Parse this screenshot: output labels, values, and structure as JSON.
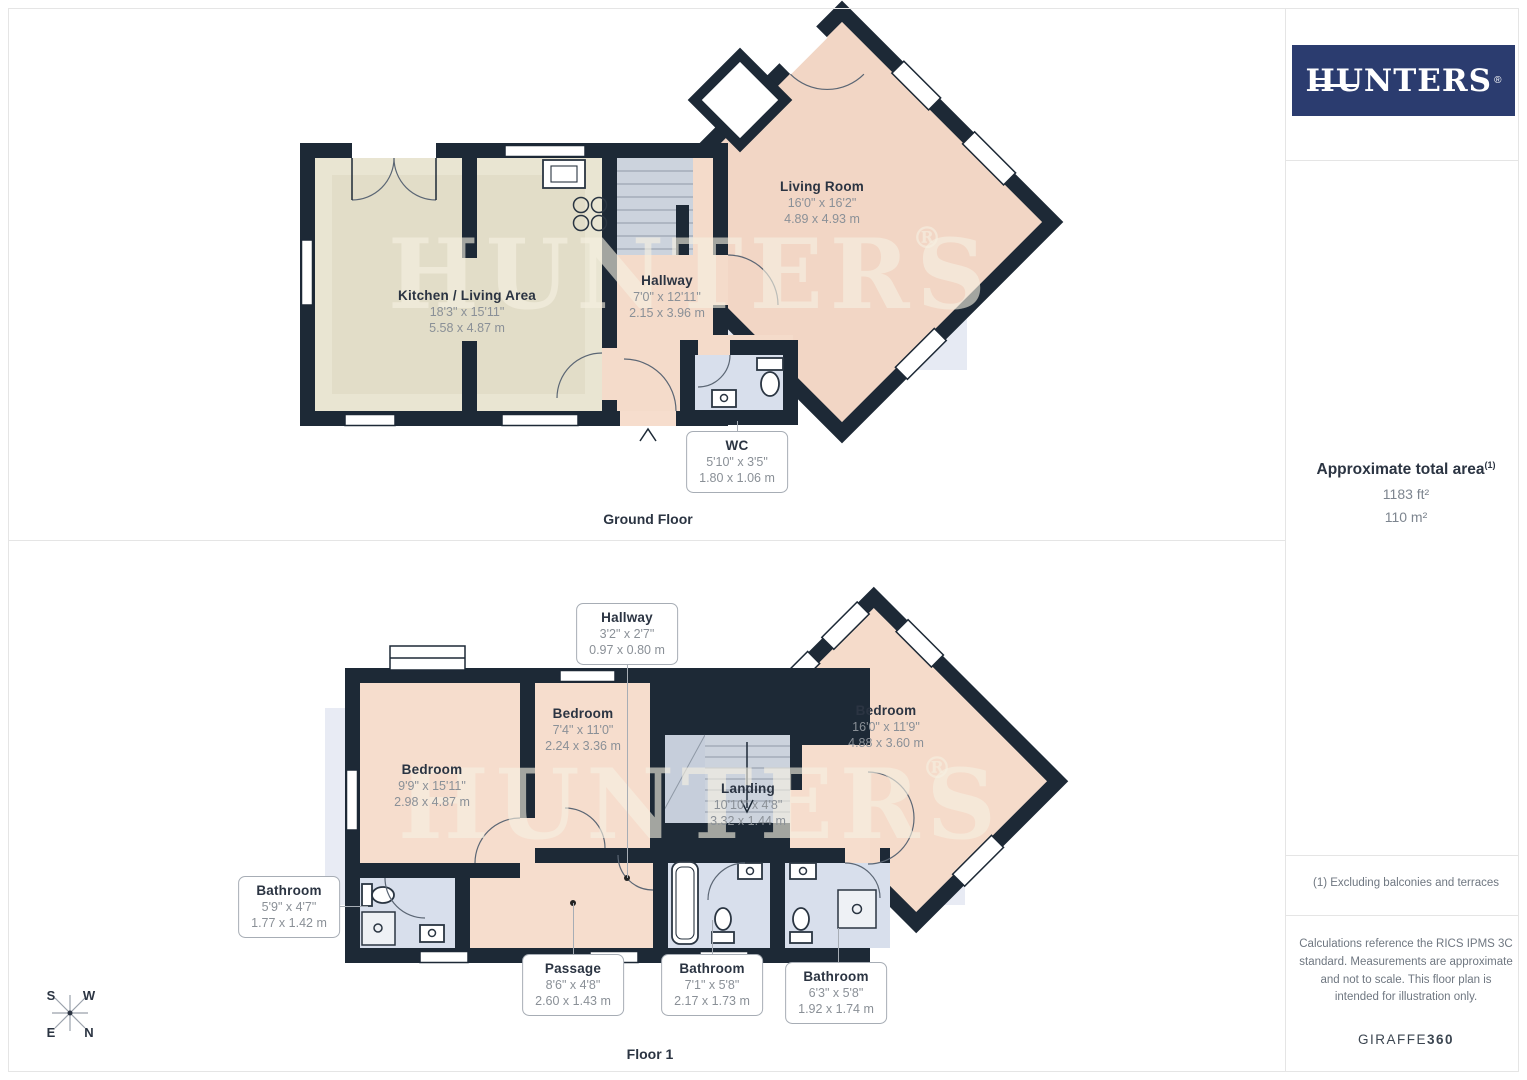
{
  "brand": {
    "logo_text": "HUNTERS",
    "registered": "®",
    "watermark": "HUNTERS",
    "watermark_reg": "®",
    "logo_bg_color": "#2b3c6f"
  },
  "sidebar": {
    "approx_label": "Approximate total area",
    "approx_sup": "(1)",
    "area_ft": "1183 ft²",
    "area_m": "110 m²",
    "footnote": "(1) Excluding balconies and terraces",
    "disclaimer": "Calculations reference the RICS IPMS 3C standard. Measurements are approximate and not to scale. This floor plan is intended for illustration only.",
    "credit_main": "GIRAFFE",
    "credit_bold": "360"
  },
  "ground_floor": {
    "title": "Ground Floor",
    "kitchen_living": {
      "name": "Kitchen / Living Area",
      "imperial": "18'3\" x 15'11\"",
      "metric": "5.58 x 4.87 m"
    },
    "hallway": {
      "name": "Hallway",
      "imperial": "7'0\" x 12'11\"",
      "metric": "2.15 x 3.96 m"
    },
    "living_room": {
      "name": "Living Room",
      "imperial": "16'0\" x 16'2\"",
      "metric": "4.89 x 4.93 m"
    },
    "wc": {
      "name": "WC",
      "imperial": "5'10\" x 3'5\"",
      "metric": "1.80 x 1.06 m"
    }
  },
  "floor1": {
    "title": "Floor 1",
    "hallway": {
      "name": "Hallway",
      "imperial": "3'2\" x 2'7\"",
      "metric": "0.97 x 0.80 m"
    },
    "bedroom_left": {
      "name": "Bedroom",
      "imperial": "9'9\" x 15'11\"",
      "metric": "2.98 x 4.87 m"
    },
    "bedroom_middle": {
      "name": "Bedroom",
      "imperial": "7'4\" x 11'0\"",
      "metric": "2.24 x 3.36 m"
    },
    "bedroom_right": {
      "name": "Bedroom",
      "imperial": "16'0\" x 11'9\"",
      "metric": "4.88 x 3.60 m"
    },
    "landing": {
      "name": "Landing",
      "imperial": "10'10\" x 4'8\"",
      "metric": "3.32 x 1.44 m"
    },
    "bathroom_left": {
      "name": "Bathroom",
      "imperial": "5'9\" x 4'7\"",
      "metric": "1.77 x 1.42 m"
    },
    "passage": {
      "name": "Passage",
      "imperial": "8'6\" x 4'8\"",
      "metric": "2.60 x 1.43 m"
    },
    "bathroom_middle": {
      "name": "Bathroom",
      "imperial": "7'1\" x 5'8\"",
      "metric": "2.17 x 1.73 m"
    },
    "bathroom_right": {
      "name": "Bathroom",
      "imperial": "6'3\" x 5'8\"",
      "metric": "1.92 x 1.74 m"
    }
  },
  "compass": {
    "n": "N",
    "s": "S",
    "e": "E",
    "w": "W"
  },
  "colors": {
    "wall": "#1d2936",
    "room_peach": "#f4dbca",
    "room_beige": "#e9e5d2",
    "room_blue": "#d8dfec",
    "stairs_gray": "#ccd3dd",
    "band_blue": "#dee3ef"
  }
}
